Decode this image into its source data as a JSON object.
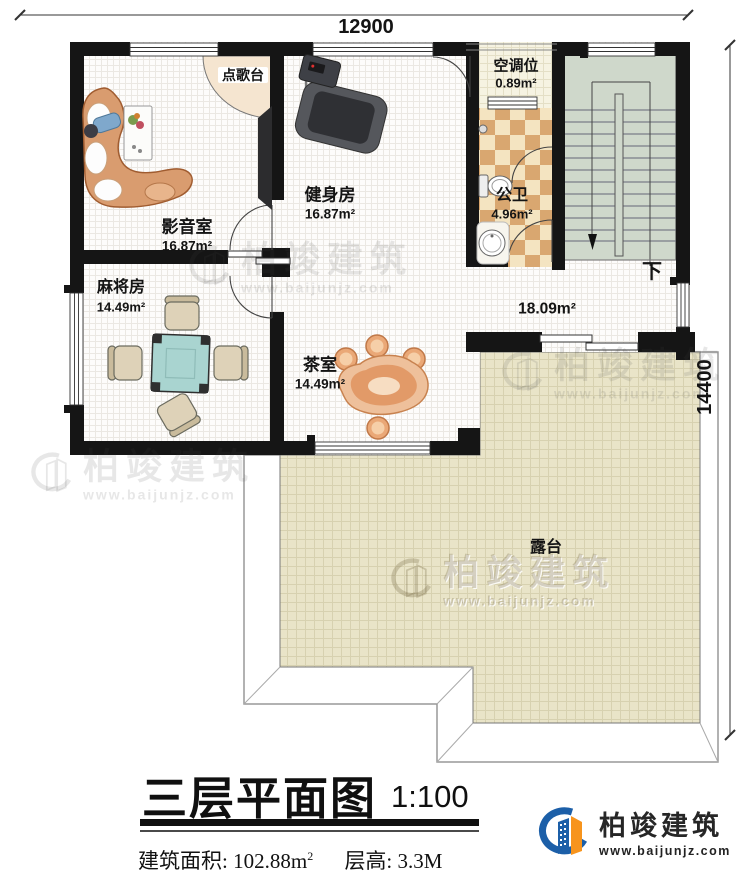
{
  "dimensions": {
    "top": "12900",
    "right": "14400"
  },
  "rooms": {
    "media": {
      "name": "影音室",
      "area": "16.87m²"
    },
    "gym": {
      "name": "健身房",
      "area": "16.87m²"
    },
    "ac": {
      "name": "空调位",
      "area": "0.89m²"
    },
    "bath": {
      "name": "公卫",
      "area": "4.96m²"
    },
    "mahjong": {
      "name": "麻将房",
      "area": "14.49m²"
    },
    "tea": {
      "name": "茶室",
      "area": "14.49m²"
    },
    "hall": {
      "area": "18.09m²"
    },
    "terrace": {
      "name": "露台"
    },
    "karaoke": {
      "name": "点歌台"
    }
  },
  "stairs": {
    "down_label": "下"
  },
  "title": {
    "text": "三层平面图",
    "scale": "1:100"
  },
  "footer": {
    "area_label": "建筑面积:",
    "area_value": "102.88m",
    "area_sup": "2",
    "height_label": "层高:",
    "height_value": "3.3M"
  },
  "brand": {
    "name": "柏竣建筑",
    "website": "www.baijunjz.com"
  },
  "colors": {
    "wall": "#151515",
    "stair_fill": "#cfd8cb",
    "terrace_fill": "#eae5c9",
    "tile_tan": "#d9a770",
    "tile_cream": "#f4e4c1",
    "logo_blue": "#1c5fa8",
    "logo_orange": "#f7941d"
  }
}
